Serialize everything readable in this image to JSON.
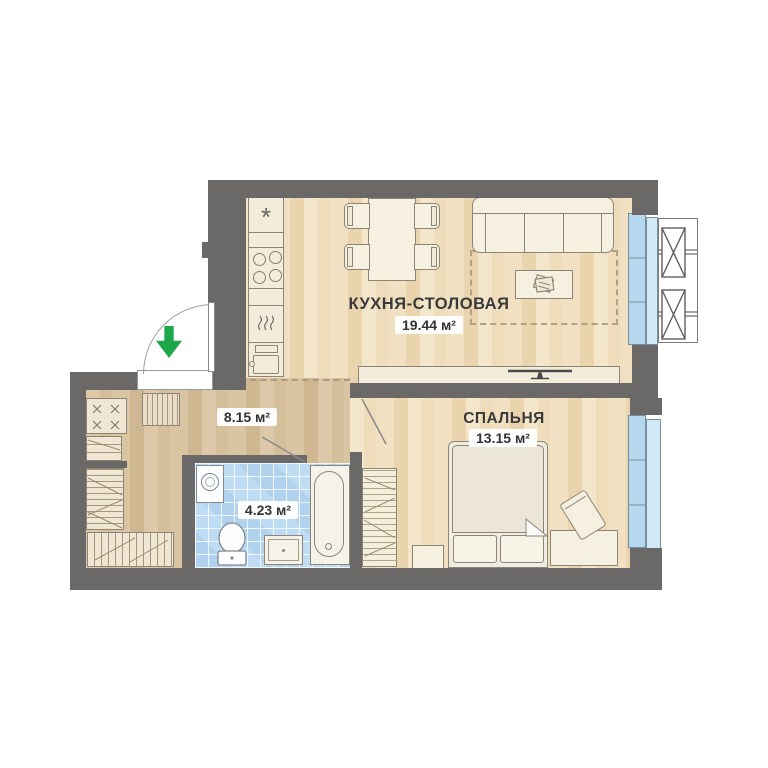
{
  "plan_type": "apartment-floor-plan",
  "rooms": {
    "kitchen_dining": {
      "name": "КУХНЯ-СТОЛОВАЯ",
      "area": "19.44 м²"
    },
    "hallway": {
      "area": "8.15 м²"
    },
    "bathroom": {
      "area": "4.23 м²"
    },
    "bedroom": {
      "name": "СПАЛЬНЯ",
      "area": "13.15 м²"
    }
  },
  "symbols": {
    "fridge": "*"
  },
  "colors": {
    "wall": "#6a6967",
    "wood_floor": "#f0e0c2",
    "hall_floor": "#d8c4a3",
    "bath_tile": "#bedcf4",
    "window_glass": "#b5d8ee",
    "loggia_glass": "#d2eaf8",
    "furniture": "#f6f0e1",
    "entry_arrow_green": "#1ea64a",
    "label_text": "#3a3a3a"
  }
}
